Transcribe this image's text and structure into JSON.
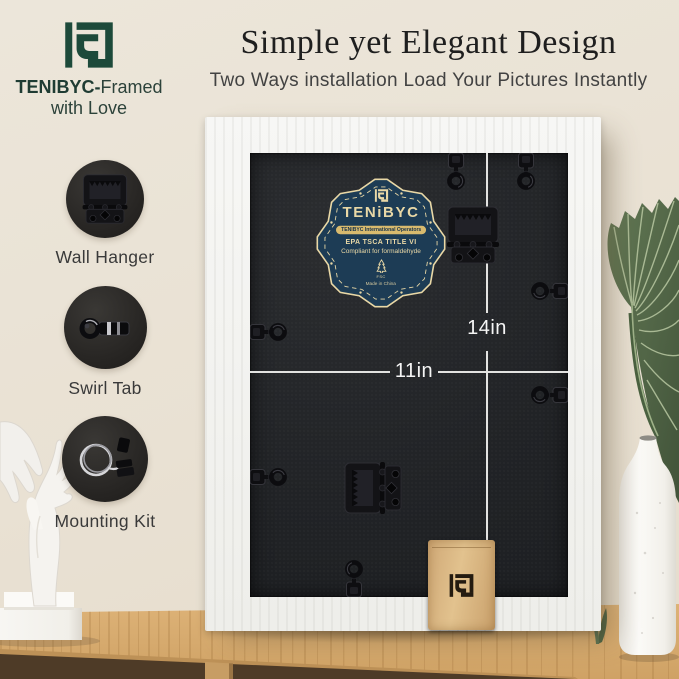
{
  "brand": {
    "line1_bold": "TENIBYC-",
    "line1_rest": "Framed",
    "line2": "with Love",
    "green": "#1d4a3a"
  },
  "header": {
    "title": "Simple yet Elegant Design",
    "subtitle": "Two Ways installation Load Your Pictures Instantly"
  },
  "features": [
    {
      "label": "Wall Hanger"
    },
    {
      "label": "Swirl Tab"
    },
    {
      "label": "Mounting Kit"
    }
  ],
  "frame_back": {
    "height_label": "14in",
    "width_label": "11in"
  },
  "badge": {
    "brand": "TENiBYC",
    "banner": "TENIBYC International Operators",
    "compliance_line1": "EPA TSCA TITLE VI",
    "compliance_line2": "Compliant for formaldehyde",
    "cert": "FSC",
    "origin": "Made in China",
    "navy": "#1d3c55",
    "cream": "#e9d8a6",
    "gold": "#d8ba6e"
  },
  "scene": {
    "wall_color": "#eae3d6",
    "table_color": "#d6aa6f",
    "frame_color": "#f5f5f2",
    "backing_color": "#232528"
  }
}
